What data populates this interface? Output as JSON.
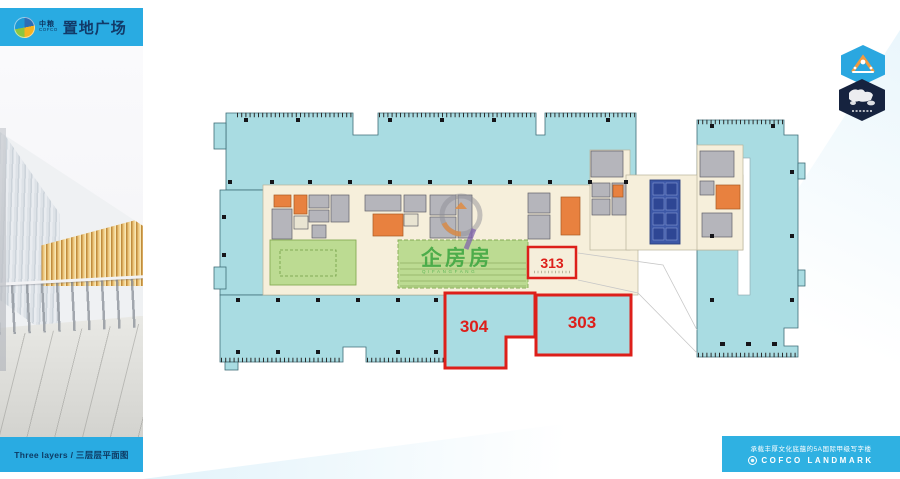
{
  "brand": {
    "logo_cn": "中粮",
    "logo_en": "COFCO",
    "title": "置地广场"
  },
  "caption": "Three layers / 三层层平面图",
  "plan": {
    "units": {
      "u313": "313",
      "u304": "304",
      "u303": "303"
    },
    "watermark": {
      "cn": "企房房",
      "en": "QIFANGFANG"
    },
    "legend_colors": {
      "office_teal": "#a9dce2",
      "core_cream": "#f6efdb",
      "service_gray": "#b5b5bb",
      "service_orange": "#e8813f",
      "garden_green": "#bcdb92",
      "hall_blue": "#3c57a6",
      "highlight_red": "#dd1f1a"
    }
  },
  "badges": {
    "top": {
      "icon": "landmark-gate-icon",
      "color": "#2aa7e0"
    },
    "bottom": {
      "icon": "world-map-icon",
      "color": "#16233f"
    }
  },
  "footer": {
    "tagline": "承载丰厚文化底蕴的5A国际甲级写字楼",
    "brand_en": "COFCO LANDMARK"
  }
}
